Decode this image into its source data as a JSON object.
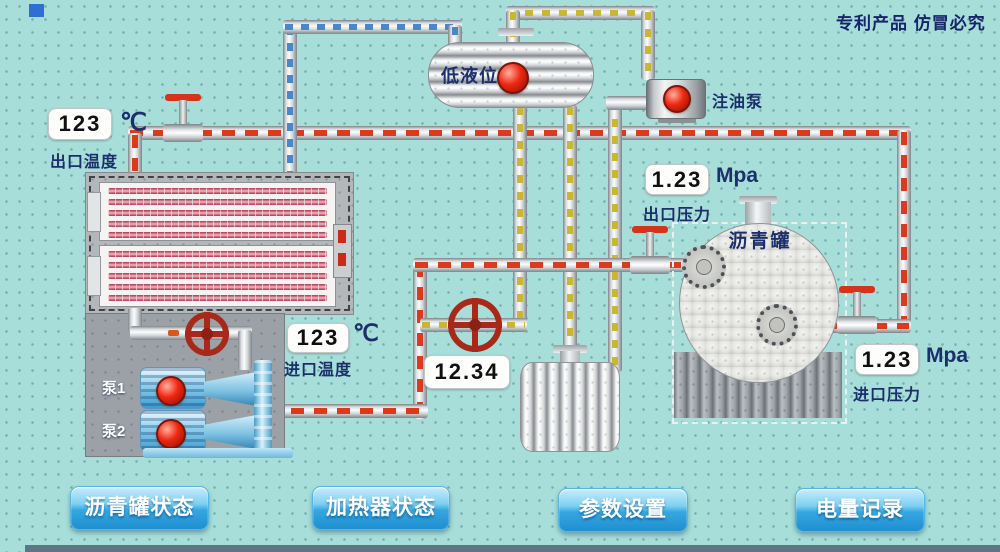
{
  "header": {
    "patent_notice": "专利产品 仿冒必究"
  },
  "displays": {
    "outlet_temp": {
      "value": "123",
      "unit": "℃",
      "label": "出口温度"
    },
    "inlet_temp": {
      "value": "123",
      "unit": "℃",
      "label": "进口温度"
    },
    "flow": {
      "value": "12.34"
    },
    "outlet_pressure": {
      "value": "1.23",
      "unit": "Mpa",
      "label": "出口压力"
    },
    "inlet_pressure": {
      "value": "1.23",
      "unit": "Mpa",
      "label": "进口压力"
    }
  },
  "equipment": {
    "low_level_tank": {
      "label": "低液位"
    },
    "injection_pump": {
      "label": "注油泵"
    },
    "asphalt_tank": {
      "label": "沥青罐"
    },
    "pump1": {
      "label": "泵1"
    },
    "pump2": {
      "label": "泵2"
    }
  },
  "buttons": [
    {
      "id": "asphalt-tank-status",
      "label": "沥青罐状态"
    },
    {
      "id": "heater-status",
      "label": "加热器状态"
    },
    {
      "id": "param-settings",
      "label": "参数设置"
    },
    {
      "id": "power-record",
      "label": "电量记录"
    }
  ],
  "colors": {
    "background": "#a7ded9",
    "hot_line_red": "#dc3a1a",
    "oil_line_yellow": "#c9b82f",
    "cool_line_blue": "#4a86c8",
    "label_navy": "#1b2f6b",
    "button_blue": "#2f9fd8"
  }
}
